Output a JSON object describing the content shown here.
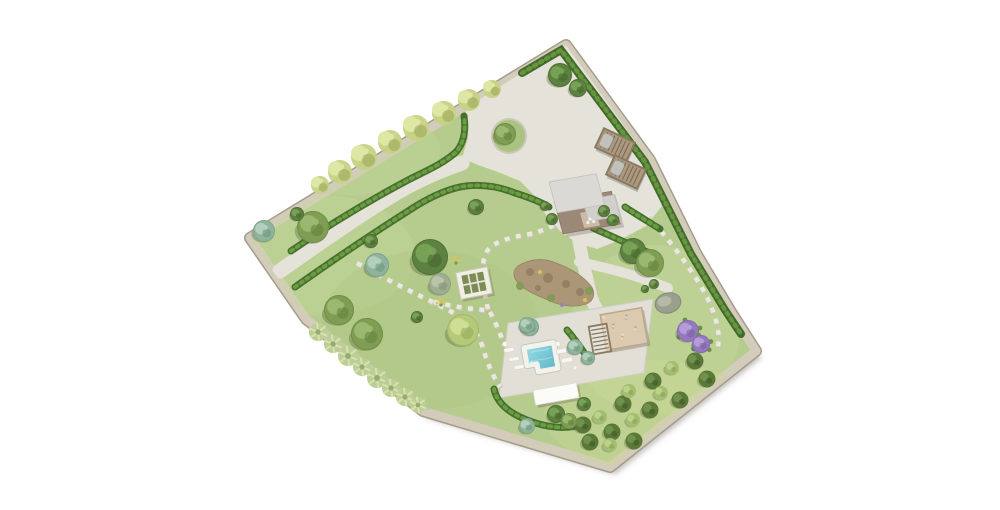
{
  "scene": {
    "width": 1000,
    "height": 510,
    "background": "#ffffff",
    "description": "aerial-landscape-garden-site-plan"
  },
  "colors": {
    "lawn": "#b6cc8e",
    "wall_fill": "#d3ccba",
    "wall_edge": "#a59d8b",
    "plot_shadow": "rgba(110,105,92,0.45)",
    "gravel": "#e4e2d9",
    "terrace": "#e1dfd6",
    "terrace_edge": "#cfcdc2",
    "stone_path": "#ebe9df",
    "stone_path_shadow": "#c9c5b7",
    "hedge_dark": "#46702e",
    "hedge_light": "#6f9e42",
    "boundary_hedge_dark": "#416a2c",
    "boundary_hedge_light": "#69973f",
    "water_top": "#9adce6",
    "water_bottom": "#5cb6c5"
  },
  "palettes": {
    "olive": {
      "base": "#7f9e53",
      "light": "#9dba72",
      "dark": "#62803c"
    },
    "dark": {
      "base": "#5d8140",
      "light": "#7aa458",
      "dark": "#46642e"
    },
    "teal": {
      "base": "#8fb49c",
      "light": "#b5d1be",
      "dark": "#6f937c"
    },
    "yellowgreen": {
      "base": "#b5c979",
      "light": "#d1e098",
      "dark": "#93a75b"
    },
    "lavender": {
      "base": "#9579c0",
      "light": "#b7a0d8",
      "dark": "#7a5fa3"
    },
    "rock": {
      "base": "#a3a994",
      "light": "#c1c6b3",
      "dark": "#858b76"
    },
    "sage": {
      "base": "#bccd95",
      "light": "#d6e3ae",
      "dark": "#99aa74"
    },
    "wallplant": {
      "base": "#c6d184",
      "light": "#dee8a4",
      "dark": "#a2af60"
    },
    "orchardDark": {
      "base": "#5a7939",
      "light": "#729450",
      "dark": "#425929"
    },
    "orchardLight": {
      "base": "#a3bd72",
      "light": "#bdd48d",
      "dark": "#86a257"
    },
    "gray": {
      "base": "#9fae90",
      "light": "#bac7ab",
      "dark": "#839175"
    }
  },
  "plot": {
    "outline": [
      [
        566,
        45
      ],
      [
        650,
        160
      ],
      [
        697,
        255
      ],
      [
        731,
        312
      ],
      [
        756,
        351
      ],
      [
        610,
        467
      ],
      [
        423,
        411
      ],
      [
        306,
        319
      ],
      [
        250,
        238
      ]
    ]
  },
  "lawn_patches": [
    {
      "cx": 320,
      "cy": 255,
      "rx": 95,
      "ry": 60,
      "fill": "#c5d89f",
      "o": 0.35
    },
    {
      "cx": 430,
      "cy": 330,
      "rx": 110,
      "ry": 80,
      "fill": "#a9c37e",
      "o": 0.3
    },
    {
      "cx": 655,
      "cy": 330,
      "rx": 85,
      "ry": 85,
      "fill": "#c8da9f",
      "o": 0.35
    },
    {
      "cx": 650,
      "cy": 415,
      "rx": 105,
      "ry": 55,
      "fill": "#ccd996",
      "o": 0.4
    },
    {
      "cx": 350,
      "cy": 150,
      "rx": 90,
      "ry": 45,
      "fill": "#c2d69b",
      "o": 0.3
    }
  ],
  "courtyard": [
    [
      466,
      108
    ],
    [
      566,
      45
    ],
    [
      650,
      162
    ],
    [
      662,
      206
    ],
    [
      646,
      226
    ],
    [
      620,
      240
    ],
    [
      597,
      249
    ],
    [
      577,
      243
    ],
    [
      560,
      231
    ],
    [
      546,
      215
    ],
    [
      536,
      197
    ],
    [
      520,
      181
    ],
    [
      498,
      172
    ],
    [
      478,
      165
    ],
    [
      462,
      158
    ],
    [
      468,
      138
    ],
    [
      466,
      112
    ]
  ],
  "island": {
    "cx": 509,
    "cy": 136,
    "r": 16,
    "grass": "#a9c480",
    "ring": "#cdc8b8"
  },
  "paths": [
    {
      "name": "driveway",
      "d": "M280,271 C318,244 358,216 398,192 C420,179 442,170 462,163",
      "width": 15
    },
    {
      "name": "south-path",
      "d": "M578,236 C581,252 585,272 590,292 C593,306 598,313 606,319",
      "width": 13
    },
    {
      "name": "east-path",
      "d": "M579,262 C608,268 636,275 668,288",
      "width": 10
    }
  ],
  "terrace_points": [
    [
      508,
      323
    ],
    [
      653,
      299
    ],
    [
      644,
      373
    ],
    [
      499,
      398
    ]
  ],
  "stepping_paths": [
    {
      "name": "stepping-path-to-pool",
      "d": "M357,263 C398,286 428,299 452,312 C468,321 477,331 482,345 C487,362 492,375 500,387"
    },
    {
      "name": "stepping-path-cross",
      "d": "M434,302 C452,306 468,309 487,310"
    },
    {
      "name": "stepping-path-to-house",
      "d": "M488,309 C482,286 480,263 487,251 C494,241 512,237 530,234 C542,231 551,227 557,223"
    },
    {
      "name": "stepping-path-terrace-link",
      "d": "M490,312 C496,324 501,335 504,345"
    },
    {
      "name": "stepping-path-east-border",
      "d": "M646,214 C664,234 681,255 695,277 C706,293 712,307 716,321 C719,331 719,340 718,347"
    }
  ],
  "hedges": [
    {
      "name": "hedge-driveway-north",
      "d": "M291,251 C330,224 374,198 410,179 C428,170 444,163 456,152 C464,143 466,130 464,116"
    },
    {
      "name": "hedge-driveway-south",
      "d": "M295,287 C336,258 378,230 416,206 C434,195 450,188 466,186 C484,184 500,187 515,193 C531,198 541,202 549,207"
    },
    {
      "name": "hedge-below-house",
      "d": "M593,228 C609,235 624,242 640,249 C647,252 652,254 656,255"
    },
    {
      "name": "hedge-east-lawn",
      "d": "M625,207 C637,215 649,222 660,229"
    },
    {
      "name": "hedge-pool-terrace",
      "d": "M494,389 C497,403 509,413 527,420 C545,427 562,429 577,426"
    },
    {
      "name": "hedge-cypress-row",
      "d": "M567,330 C573,337 579,345 585,354"
    }
  ],
  "boundary_hedge": {
    "d": "M522,73 L561,50 L645,162 L691,254 L725,310 L741,334"
  },
  "wall_plants": [
    [
      340,
      172,
      12
    ],
    [
      364,
      157,
      13
    ],
    [
      390,
      142,
      12
    ],
    [
      416,
      128,
      13
    ],
    [
      444,
      113,
      12
    ],
    [
      469,
      100,
      11
    ],
    [
      492,
      89,
      9
    ],
    [
      320,
      185,
      9
    ]
  ],
  "agaves": [
    [
      318,
      332,
      9
    ],
    [
      333,
      344,
      9
    ],
    [
      348,
      356,
      10
    ],
    [
      362,
      367,
      9
    ],
    [
      377,
      378,
      10
    ],
    [
      391,
      388,
      9
    ],
    [
      405,
      397,
      9
    ],
    [
      418,
      405,
      8
    ]
  ],
  "trees": [
    [
      313,
      227,
      16,
      "olive"
    ],
    [
      264,
      231,
      11,
      "teal"
    ],
    [
      297,
      214,
      7,
      "dark"
    ],
    [
      560,
      75,
      12,
      "dark"
    ],
    [
      578,
      88,
      9,
      "dark"
    ],
    [
      430,
      257,
      18,
      "dark"
    ],
    [
      440,
      284,
      11,
      "gray"
    ],
    [
      377,
      265,
      12,
      "teal"
    ],
    [
      371,
      241,
      7,
      "dark"
    ],
    [
      476,
      207,
      8,
      "dark"
    ],
    [
      463,
      330,
      16,
      "yellowgreen"
    ],
    [
      530,
      327,
      9,
      "teal"
    ],
    [
      417,
      317,
      6,
      "dark"
    ],
    [
      339,
      310,
      15,
      "olive"
    ],
    [
      367,
      334,
      16,
      "olive"
    ],
    [
      575,
      347,
      8,
      "teal"
    ],
    [
      588,
      358,
      7,
      "teal"
    ],
    [
      527,
      325,
      8,
      "teal"
    ],
    [
      633,
      251,
      13,
      "dark"
    ],
    [
      650,
      263,
      14,
      "olive"
    ],
    [
      654,
      284,
      5,
      "dark"
    ],
    [
      645,
      289,
      4,
      "dark"
    ],
    [
      688,
      331,
      11,
      "lavender"
    ],
    [
      701,
      344,
      9,
      "lavender"
    ],
    [
      556,
      414,
      9,
      "dark"
    ],
    [
      569,
      421,
      8,
      "olive"
    ],
    [
      584,
      404,
      7,
      "dark"
    ],
    [
      527,
      426,
      8,
      "teal"
    ],
    [
      552,
      219,
      6,
      "dark"
    ],
    [
      604,
      211,
      6,
      "dark"
    ],
    [
      613,
      220,
      6,
      "dark"
    ],
    [
      545,
      206,
      5,
      "dark"
    ],
    [
      505,
      134,
      11,
      "olive"
    ]
  ],
  "lavender_leaf_offsets": [
    [
      -9,
      6
    ],
    [
      10,
      7
    ],
    [
      -3,
      -11
    ],
    [
      12,
      -3
    ]
  ],
  "orchard": {
    "r_dark": 8.5,
    "r_light": 7,
    "dark": [
      [
        583,
        425
      ],
      [
        612,
        432
      ],
      [
        623,
        404
      ],
      [
        650,
        410
      ],
      [
        653,
        381
      ],
      [
        680,
        400
      ],
      [
        695,
        361
      ],
      [
        707,
        379
      ],
      [
        590,
        442
      ],
      [
        634,
        441
      ]
    ],
    "light": [
      [
        600,
        417
      ],
      [
        629,
        391
      ],
      [
        633,
        420
      ],
      [
        661,
        393
      ],
      [
        672,
        368
      ],
      [
        610,
        445
      ]
    ]
  },
  "flowers": {
    "yellow_fill": "#d9c44e",
    "green_fill": "#7f9a53",
    "clusters": [
      [
        455,
        258
      ],
      [
        440,
        300
      ]
    ]
  },
  "structures": {
    "house": {
      "x": 549,
      "y": 182,
      "matrix": [
        0.985,
        -0.17,
        0.26,
        0.96
      ],
      "base": {
        "x": 0,
        "y": 20,
        "w": 58,
        "h": 34,
        "fill": "#9b8876",
        "edge": "#86745f"
      },
      "roof_main": {
        "x": 0,
        "y": 0,
        "w": 48,
        "h": 32,
        "fill": "#dbd9d5",
        "edge": "#c3c1bd"
      },
      "roof_ext": {
        "x": 28,
        "y": 24,
        "w": 32,
        "h": 22,
        "fill": "#d2d0cc",
        "edge": "#bfbdb9"
      },
      "awning": {
        "x": 22,
        "y": 36,
        "w": 16,
        "h": 16,
        "fill": "#cdbba5"
      },
      "furniture": [
        [
          30,
          44
        ],
        [
          27,
          47
        ],
        [
          33,
          47
        ]
      ]
    },
    "carports": {
      "angle": 25,
      "w": 34,
      "h": 21,
      "frame": "#8a7a61",
      "fill": "#ab9a80",
      "slat": "#6f614b",
      "car": "#c2c0bb",
      "items": [
        [
          615,
          145
        ],
        [
          626,
          172
        ]
      ]
    },
    "pool_pergola": {
      "cx": 624,
      "cy": 329,
      "angle": -10,
      "w": 42,
      "h": 36,
      "fill": "#dbc9b0",
      "edge": "#bda788",
      "speckle1": "#c6ae8e",
      "speckle2": "#eadcc5",
      "slat_part": {
        "cx": 600,
        "cy": 339,
        "w": 18,
        "h": 28
      }
    },
    "garden_pergola": {
      "cx": 474,
      "cy": 283,
      "angle": -11,
      "w": 32,
      "h": 27,
      "frame": "#f1efe4",
      "edge": "#cdcaba",
      "inner": "#7d8b55",
      "bar": "#e8e6da"
    },
    "pool": {
      "cx": 541,
      "cy": 358,
      "angle": -10,
      "coping": "#f3f2ec",
      "coping_edge": "#c9c7bb",
      "points": [
        [
          -15,
          -13
        ],
        [
          15,
          -13
        ],
        [
          15,
          13
        ],
        [
          -5,
          13
        ],
        [
          -5,
          5
        ],
        [
          -15,
          5
        ]
      ]
    },
    "pool_house": {
      "cx": 556,
      "cy": 394,
      "angle": -10,
      "w": 44,
      "h": 15,
      "fill": "#fbfbf8",
      "edge": "#dedcd1"
    },
    "loungers": {
      "angle": -10,
      "fill": "#f7f6f2",
      "edge": "#d9d7cc",
      "items": [
        [
          509,
          350,
          10,
          4
        ],
        [
          514,
          359,
          10,
          4
        ],
        [
          519,
          367,
          10,
          4
        ],
        [
          562,
          351,
          11,
          4.5
        ],
        [
          567,
          360,
          11,
          4.5
        ]
      ],
      "tables": [
        [
          505,
          344,
          2.5
        ],
        [
          558,
          344,
          2.5
        ],
        [
          575,
          368,
          2
        ]
      ]
    },
    "rock_bed": {
      "d": "M518,266 C530,258 545,258 556,263 C570,268 583,276 591,286 C596,293 594,301 586,304 C574,308 560,306 548,300 C536,295 524,290 518,283 C513,277 512,271 518,266 Z",
      "fill": "#ab9678",
      "spots": [
        [
          530,
          272,
          4
        ],
        [
          548,
          278,
          5
        ],
        [
          566,
          284,
          4
        ],
        [
          580,
          292,
          4
        ],
        [
          538,
          288,
          3
        ]
      ],
      "spot_fill": "#8f7c61",
      "greens": [
        [
          520,
          286,
          4
        ],
        [
          551,
          298,
          4
        ],
        [
          589,
          291,
          4
        ]
      ],
      "green_fill": "#7f9a53",
      "yellows": [
        [
          540,
          272
        ],
        [
          585,
          300
        ]
      ],
      "yellow_fill": "#d9c44e",
      "purples": [
        [
          562,
          305
        ]
      ],
      "purple_fill": "#a07fc0"
    },
    "boulder": {
      "cx": 668,
      "cy": 303,
      "rx": 13,
      "ry": 10,
      "angle": -15,
      "fill": "#9aa08d",
      "edge": "#848a77",
      "light": "#b9beac"
    }
  }
}
